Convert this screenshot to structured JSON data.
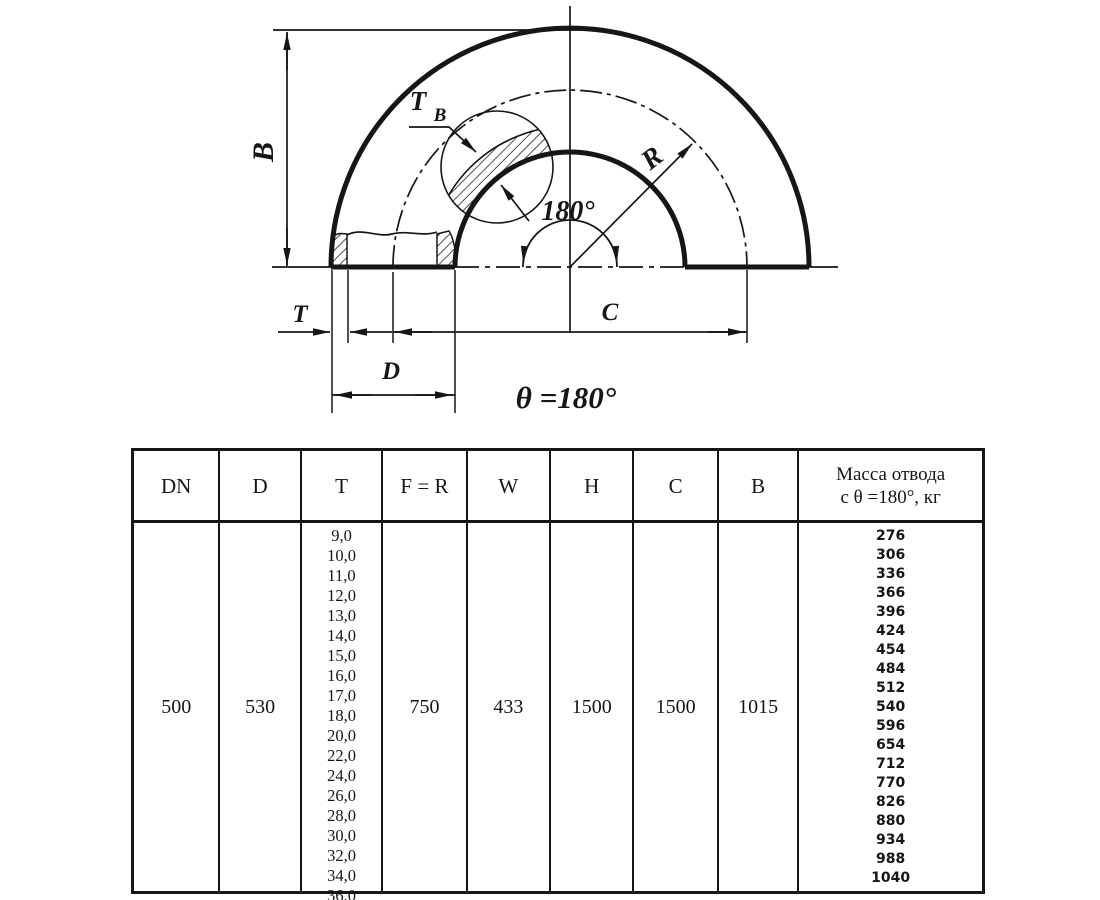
{
  "colors": {
    "ink": "#161616",
    "paper": "#ffffff"
  },
  "drawing": {
    "dim_b": "B",
    "dim_t": "T",
    "dim_d": "D",
    "dim_c": "C",
    "radius_label": "R",
    "angle_label": "180°",
    "theta_label": "θ =180°",
    "wall_label_main": "T",
    "wall_label_sub": "B"
  },
  "table": {
    "headers": [
      "DN",
      "D",
      "T",
      "F = R",
      "W",
      "H",
      "C",
      "B"
    ],
    "mass_header": [
      "Масса отвода",
      "с θ =180°, кг"
    ],
    "values": {
      "dn": "500",
      "d": "530",
      "f_r": "750",
      "w": "433",
      "h": "1500",
      "c": "1500",
      "b": "1015"
    },
    "t_values": [
      "9,0",
      "10,0",
      "11,0",
      "12,0",
      "13,0",
      "14,0",
      "15,0",
      "16,0",
      "17,0",
      "18,0",
      "20,0",
      "22,0",
      "24,0",
      "26,0",
      "28,0",
      "30,0",
      "32,0",
      "34,0",
      "36,0"
    ],
    "mass_values": [
      "276",
      "306",
      "336",
      "366",
      "396",
      "424",
      "454",
      "484",
      "512",
      "540",
      "596",
      "654",
      "712",
      "770",
      "826",
      "880",
      "934",
      "988",
      "1040"
    ]
  }
}
